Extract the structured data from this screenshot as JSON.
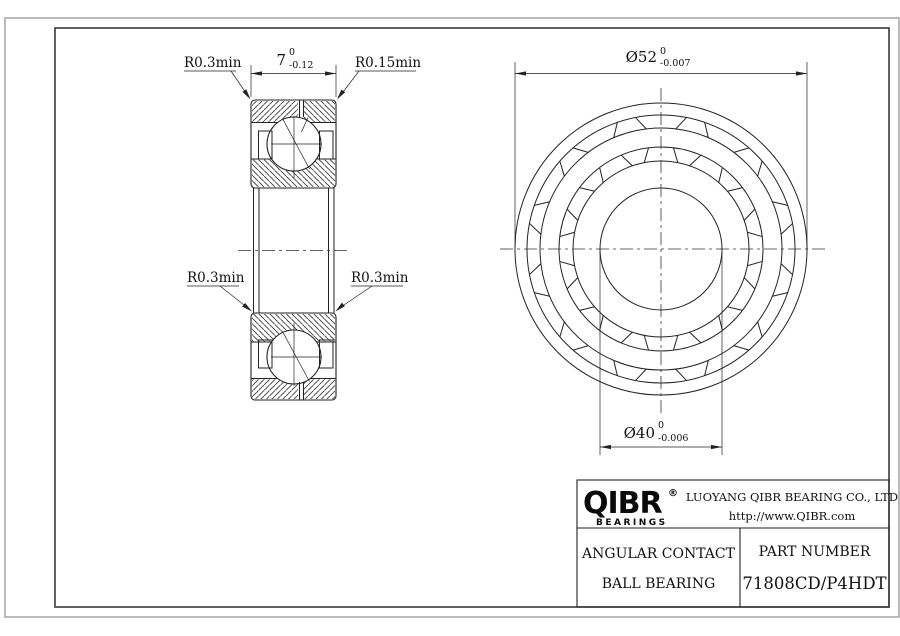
{
  "drawing": {
    "labels": {
      "r03": "R0.3min",
      "r015": "R0.15min"
    },
    "dims": {
      "width": {
        "value": "7",
        "tol_up": "0",
        "tol_dn": "-0.12"
      },
      "od": {
        "value": "Ø52",
        "tol_up": "0",
        "tol_dn": "-0.007"
      },
      "bore": {
        "value": "Ø40",
        "tol_up": "0",
        "tol_dn": "-0.006"
      }
    }
  },
  "title_block": {
    "logo": {
      "name": "QIBR",
      "reg": "®",
      "sub": "BEARINGS"
    },
    "company": "LUOYANG QIBR BEARING CO., LTD",
    "website": "http://www.QIBR.com",
    "product_line1": "ANGULAR CONTACT",
    "product_line2": "BALL BEARING",
    "part_label": "PART NUMBER",
    "part_number": "71808CD/P4HDT"
  },
  "colors": {
    "line": "#222222",
    "frame": "#3a3a3a",
    "page_edge": "#a8a8a8"
  }
}
